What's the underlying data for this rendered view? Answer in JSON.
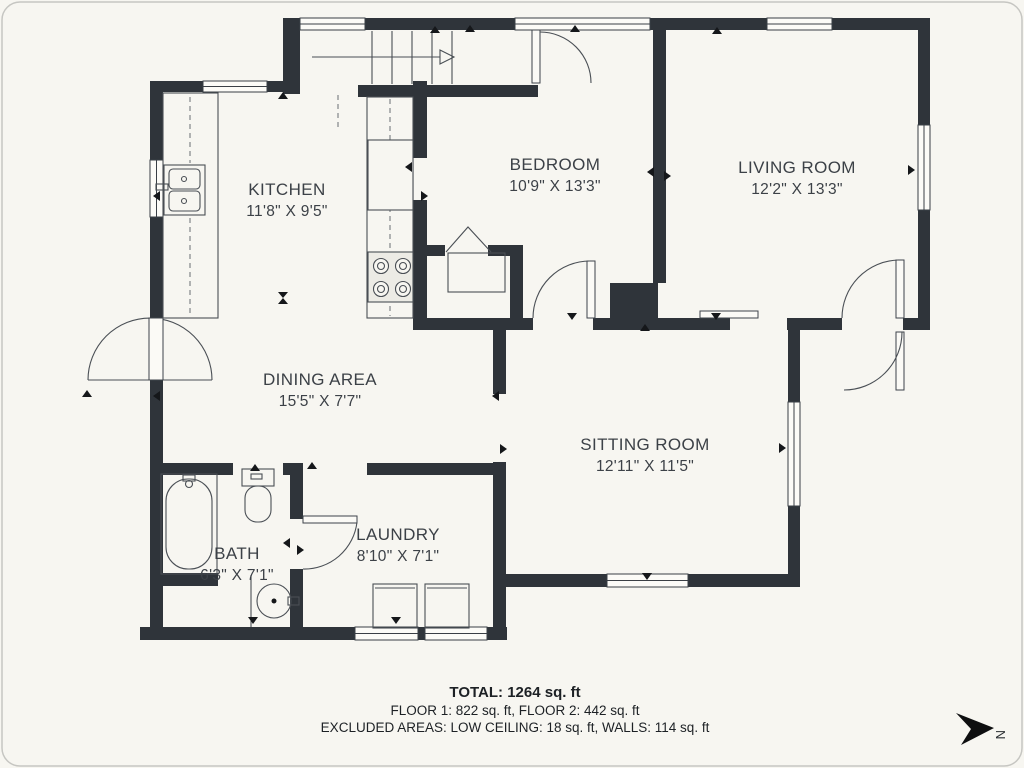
{
  "rooms": [
    {
      "name": "KITCHEN",
      "dims": "11'8\" X 9'5\""
    },
    {
      "name": "BEDROOM",
      "dims": "10'9\" X 13'3\""
    },
    {
      "name": "LIVING ROOM",
      "dims": "12'2\" X 13'3\""
    },
    {
      "name": "DINING AREA",
      "dims": "15'5\" X 7'7\""
    },
    {
      "name": "SITTING ROOM",
      "dims": "12'11\" X 11'5\""
    },
    {
      "name": "BATH",
      "dims": "6'3\" X 7'1\""
    },
    {
      "name": "LAUNDRY",
      "dims": "8'10\" X 7'1\""
    }
  ],
  "footer": {
    "total": "TOTAL: 1264 sq. ft",
    "floors": "FLOOR 1: 822 sq. ft, FLOOR 2: 442 sq. ft",
    "excluded": "EXCLUDED AREAS: LOW CEILING: 18 sq. ft, WALLS: 114 sq. ft"
  },
  "compass": {
    "label": "N"
  },
  "colors": {
    "background": "#f7f6f1",
    "wall": "#2f343a",
    "line": "#4a4f55",
    "text": "#3c4147"
  }
}
